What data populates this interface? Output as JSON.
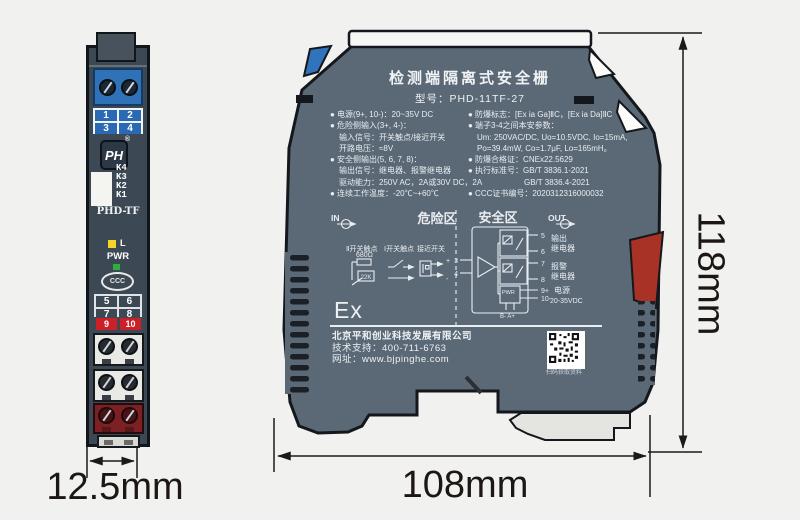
{
  "colors": {
    "side_body": "#5b6977",
    "front_body": "#3c4854",
    "terminal_blue": "#2f72b8",
    "terminal_red": "#cb2027",
    "power_block_red": "#7c2023",
    "clip_blue": "#2f74bd",
    "clip_red": "#a93226",
    "led_yellow": "#f5d327",
    "led_green": "#2fae3e"
  },
  "front_view": {
    "top_terminals": [
      "1",
      "2",
      "3",
      "4"
    ],
    "logo_text": "PH",
    "logo_reg": "®",
    "k_labels": [
      "K4",
      "K3",
      "K2",
      "K1"
    ],
    "model": "PHD-TF",
    "led_label": "L",
    "pwr_label": "PWR",
    "ccc_label": "CCC",
    "mid_terminals": [
      "5",
      "6",
      "7",
      "8"
    ],
    "power_terminals": [
      "9",
      "10"
    ]
  },
  "side_view": {
    "title": "检测端隔离式安全栅",
    "model_line": "型号：PHD-11TF-27",
    "specs_left": [
      "● 电源(9+, 10-)：20~35V DC",
      "● 危险侧输入(3+, 4-)：",
      "输入信号：开关触点/接近开关",
      "开路电压：≈8V",
      "● 安全侧输出(5, 6, 7, 8)：",
      "输出信号：继电器、报警继电器",
      "驱动能力：250V AC，2A或30V DC，2A",
      "● 连续工作温度：-20℃~+60℃"
    ],
    "specs_right": [
      "● 防爆标志：[Ex ia Ga]ⅡC，[Ex ia Da]ⅡC",
      "● 端子3-4之间本安参数：",
      "Um: 250VAC/DC, Uo=10.5VDC, Io=15mA,",
      "Po=39.4mW,  Co=1.7μF,  Lo=165mH。",
      "● 防爆合格证：CNEx22.5629",
      "● 执行标准号：GB/T 3836.1-2021",
      "GB/T 3836.4-2021",
      "● CCC证书编号：2020312316000032"
    ],
    "ex_mark": "Ex",
    "company": "北京平和创业科技发展有限公司",
    "support": "技术支持：400-711-6763",
    "website": "网址：www.bjpinghe.com",
    "qr_caption": "扫码获取资料",
    "circuit": {
      "in": "IN",
      "out": "OUT",
      "zone_danger": "危险区",
      "zone_safe": "安全区",
      "sw2_label": "Ⅱ开关触点",
      "sw2_res1": "680Ω",
      "sw2_res2": "22K",
      "sw1_label": "Ⅰ开关触点",
      "prox_label": "接近开关",
      "plus": "+",
      "minus": "-",
      "t3": "3",
      "t4": "4",
      "t5": "5",
      "t6": "6",
      "t7": "7",
      "t8": "8",
      "t9": "9+",
      "t10": "10-",
      "out_relay_l1": "输出",
      "out_relay_l2": "继电器",
      "alarm_relay_l1": "报警",
      "alarm_relay_l2": "继电器",
      "pwr_box": "PWR",
      "power_l1": "电源",
      "power_l2": "20-35VDC",
      "ba_label": "B- A+"
    }
  },
  "dimensions": {
    "front_width": "12.5mm",
    "side_width": "108mm",
    "side_height": "118mm"
  }
}
